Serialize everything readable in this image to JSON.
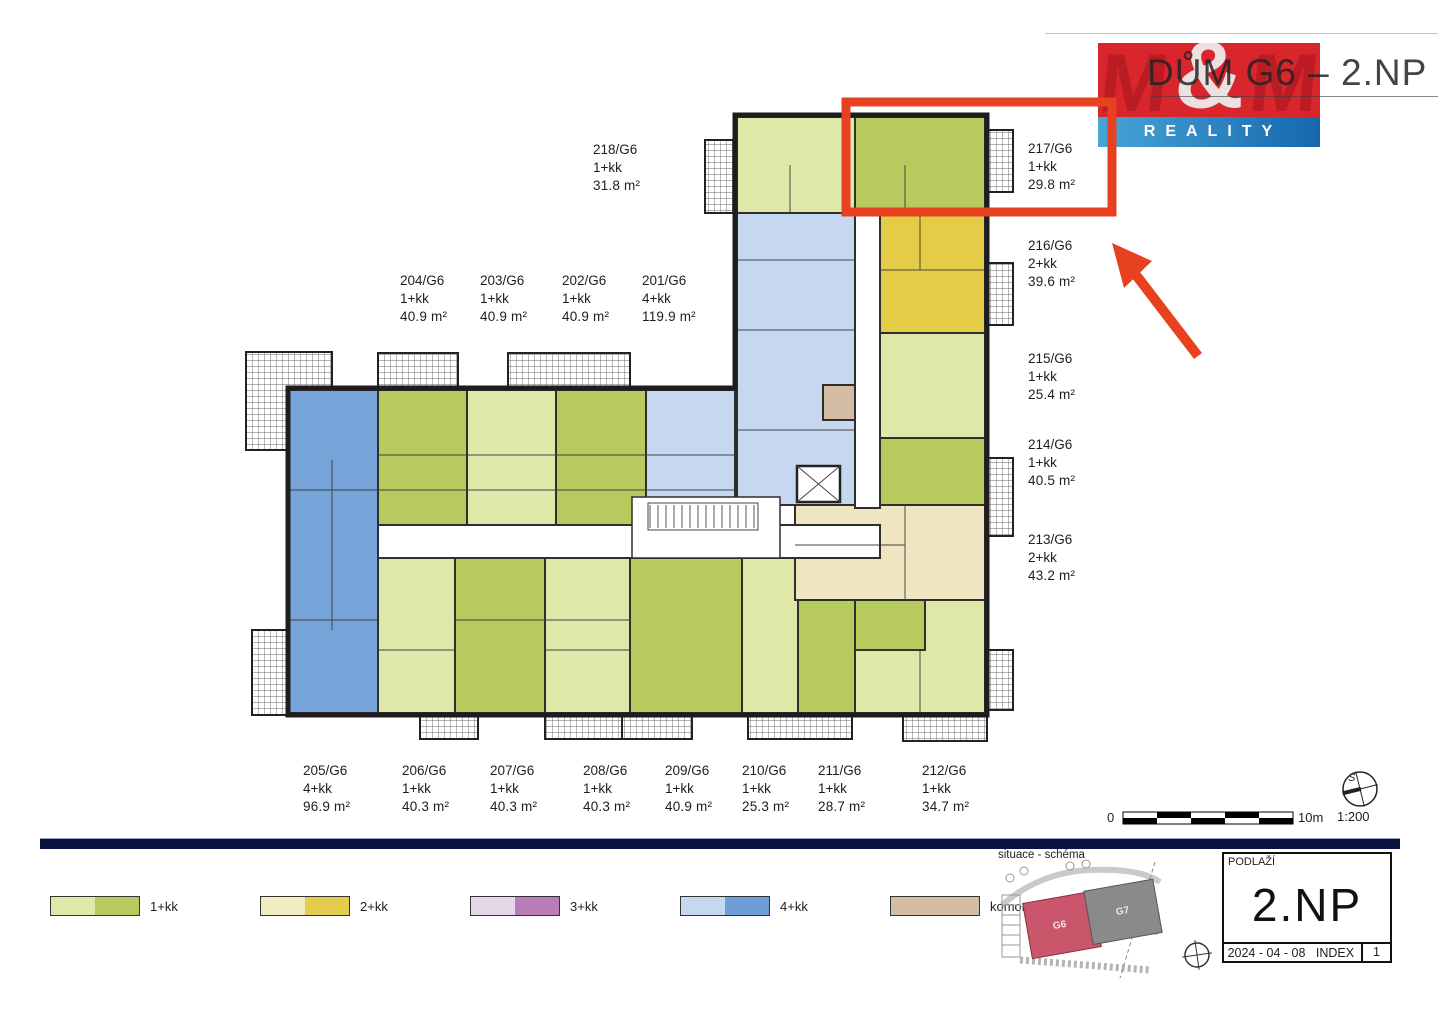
{
  "title": "DŮM G6 – 2.NP",
  "logo": {
    "m_left": "M",
    "ampersand": "&",
    "m_right": "M",
    "reality": "REALITY"
  },
  "units": [
    {
      "id": "201/G6",
      "type": "4+kk",
      "area": "119.9 m²"
    },
    {
      "id": "202/G6",
      "type": "1+kk",
      "area": "40.9 m²"
    },
    {
      "id": "203/G6",
      "type": "1+kk",
      "area": "40.9 m²"
    },
    {
      "id": "204/G6",
      "type": "1+kk",
      "area": "40.9 m²"
    },
    {
      "id": "205/G6",
      "type": "4+kk",
      "area": "96.9 m²"
    },
    {
      "id": "206/G6",
      "type": "1+kk",
      "area": "40.3 m²"
    },
    {
      "id": "207/G6",
      "type": "1+kk",
      "area": "40.3 m²"
    },
    {
      "id": "208/G6",
      "type": "1+kk",
      "area": "40.3 m²"
    },
    {
      "id": "209/G6",
      "type": "1+kk",
      "area": "40.9 m²"
    },
    {
      "id": "210/G6",
      "type": "1+kk",
      "area": "25.3 m²"
    },
    {
      "id": "211/G6",
      "type": "1+kk",
      "area": "28.7 m²"
    },
    {
      "id": "212/G6",
      "type": "1+kk",
      "area": "34.7 m²"
    },
    {
      "id": "213/G6",
      "type": "2+kk",
      "area": "43.2 m²"
    },
    {
      "id": "214/G6",
      "type": "1+kk",
      "area": "40.5 m²"
    },
    {
      "id": "215/G6",
      "type": "1+kk",
      "area": "25.4 m²"
    },
    {
      "id": "216/G6",
      "type": "2+kk",
      "area": "39.6 m²"
    },
    {
      "id": "217/G6",
      "type": "1+kk",
      "area": "29.8 m²"
    },
    {
      "id": "218/G6",
      "type": "1+kk",
      "area": "31.8 m²"
    }
  ],
  "storage": {
    "id": "K201/G6",
    "area": "3.3 m²"
  },
  "legend": [
    {
      "label": "1+kk",
      "colors": [
        "#dfe7a9",
        "#b6ca5e"
      ]
    },
    {
      "label": "2+kk",
      "colors": [
        "#f2ecc2",
        "#e5cc4e"
      ]
    },
    {
      "label": "3+kk",
      "colors": [
        "#e7d6e8",
        "#b87cb6"
      ]
    },
    {
      "label": "4+kk",
      "colors": [
        "#c5d8ef",
        "#6f9ed6"
      ]
    },
    {
      "label": "komory",
      "colors": [
        "#d3bda4"
      ]
    }
  ],
  "scale": {
    "zero": "0",
    "ten": "10m",
    "ratio": "1:200",
    "compass": "S"
  },
  "site": {
    "label": "situace - schéma",
    "g6": "G6",
    "g7": "G7"
  },
  "titleblock": {
    "header": "PODLAŽÍ",
    "floor": "2.NP",
    "date": "2024 - 04 - 08",
    "index_label": "INDEX",
    "index_value": "1"
  },
  "highlight": {
    "color": "#e8411f",
    "highlighted_unit": "217/G6"
  }
}
